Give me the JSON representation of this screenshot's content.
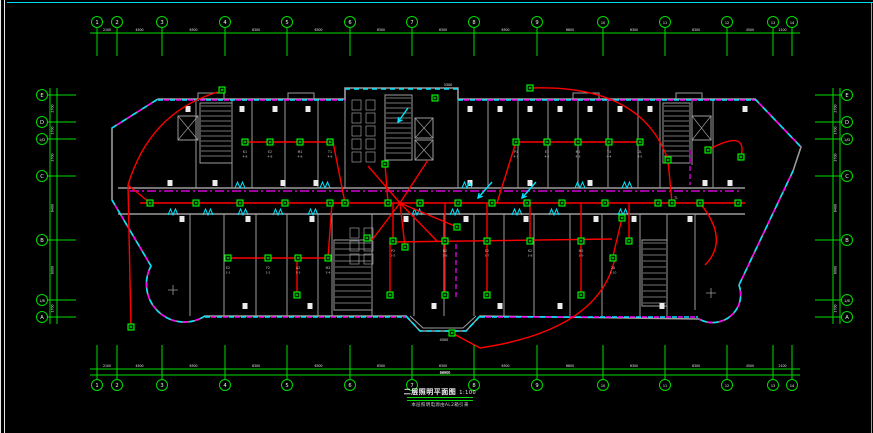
{
  "drawing": {
    "title": "二层照明平面图",
    "title_scale": "1:100",
    "subtitle": "本层照明电源由AL2箱引来",
    "colors": {
      "grid": "#00dc00",
      "bubble_text": "#e6ffe6",
      "dim_text": "#e8e8e8",
      "wall": "#9c9c9c",
      "wire": "#ff0000",
      "device": "#00ff00",
      "device_fill": "#002a00",
      "tray_cyan": "#00e5ff",
      "tray_magenta": "#ff00ff",
      "label": "#c8c8c8",
      "block": "#ececec"
    },
    "grid": {
      "top": {
        "labels": [
          "1",
          "2",
          "3",
          "4",
          "5",
          "6",
          "7",
          "8",
          "9",
          "10",
          "11",
          "12",
          "13",
          "14"
        ],
        "x": [
          97,
          117,
          162,
          225,
          287,
          350,
          412,
          474,
          537,
          603,
          665,
          727,
          773,
          792
        ],
        "bubble_y": 22,
        "line_y": 33,
        "stem_y1": 27,
        "stem_y2": 56,
        "dims": [
          "2100",
          "4500",
          "6300",
          "6300",
          "6300",
          "6300",
          "6300",
          "6300",
          "6600",
          "6300",
          "6300",
          "4500",
          "2100"
        ]
      },
      "bottom": {
        "labels": [
          "1",
          "2",
          "3",
          "4",
          "5",
          "6",
          "7",
          "8",
          "9",
          "10",
          "11",
          "12",
          "13",
          "14"
        ],
        "x": [
          97,
          117,
          162,
          225,
          287,
          350,
          412,
          474,
          537,
          603,
          665,
          727,
          773,
          792
        ],
        "bubble_y": 385,
        "line_y": 369,
        "line2_y": 375,
        "stem_y1": 345,
        "stem_y2": 379,
        "dims": [
          "2100",
          "4500",
          "6300",
          "6300",
          "6300",
          "6300",
          "6300",
          "6300",
          "6600",
          "6300",
          "6300",
          "4500",
          "2100"
        ],
        "overall": "66900"
      },
      "left": {
        "labels": [
          "E",
          "D",
          "1/D",
          "C",
          "B",
          "1/B",
          "A"
        ],
        "y": [
          95,
          122,
          139,
          176,
          240,
          300,
          317
        ],
        "bubble_x": 42,
        "line_x": [
          50,
          57
        ],
        "stem_x1": 47,
        "stem_x2": 76,
        "dims": [
          "2700",
          "1700",
          "3700",
          "6400",
          "6000",
          "1700"
        ]
      },
      "right": {
        "labels": [
          "E",
          "D",
          "1/D",
          "C",
          "B",
          "1/B",
          "A"
        ],
        "y": [
          95,
          122,
          139,
          176,
          240,
          300,
          317
        ],
        "bubble_x": 847,
        "line_x": [
          833,
          840
        ],
        "stem_x1": 815,
        "stem_x2": 842,
        "dims": [
          "2700",
          "1700",
          "3700",
          "6400",
          "6000",
          "1700"
        ]
      }
    },
    "stairs": [
      {
        "x": 200,
        "y": 103,
        "w": 32,
        "h": 60,
        "step": 5
      },
      {
        "x": 385,
        "y": 95,
        "w": 27,
        "h": 65,
        "step": 5
      },
      {
        "x": 663,
        "y": 103,
        "w": 27,
        "h": 60,
        "step": 5
      },
      {
        "x": 334,
        "y": 240,
        "w": 38,
        "h": 70,
        "step": 6
      },
      {
        "x": 642,
        "y": 240,
        "w": 25,
        "h": 66,
        "step": 6
      }
    ],
    "elevators": [
      {
        "x": 178,
        "y": 116,
        "w": 20,
        "h": 24
      },
      {
        "x": 415,
        "y": 118,
        "w": 18,
        "h": 20
      },
      {
        "x": 415,
        "y": 140,
        "w": 18,
        "h": 20
      },
      {
        "x": 692,
        "y": 116,
        "w": 19,
        "h": 24
      }
    ],
    "stalls": {
      "x": 352,
      "y": 100,
      "w": 9,
      "h": 10,
      "rows": 5,
      "cols": 2,
      "dx": 14,
      "dy": 13
    },
    "stalls2": {
      "x": 350,
      "y": 228,
      "w": 9,
      "h": 10,
      "rows": 3,
      "cols": 2,
      "dx": 14,
      "dy": 13
    },
    "white_blocks": [
      {
        "y": 109,
        "x": [
          188,
          242,
          275,
          308,
          470,
          500,
          530,
          560,
          590,
          620,
          650,
          745
        ]
      },
      {
        "y": 183,
        "x": [
          170,
          215,
          283,
          316,
          470,
          530,
          590,
          705,
          730
        ]
      },
      {
        "y": 219,
        "x": [
          182,
          248,
          312,
          406,
          466,
          526,
          596,
          634,
          690
        ]
      },
      {
        "y": 306,
        "x": [
          245,
          310,
          434,
          500,
          560,
          662
        ]
      }
    ],
    "dash_paths": [
      "M158,100 L345,100",
      "M458,100 L755,100",
      "M112,128 L158,99",
      "M755,99 L801,147",
      "M793,171 L739,285",
      "M112,200 L151,266",
      "M205,317 L406,317",
      "M480,317 L698,317",
      "M739,285 A28,28 0 0 1 699,319",
      "M205,316 A38,38 0 0 1 151,266"
    ],
    "cyan_paths": [
      "M345,89 L458,89",
      "M406,316 L420,331 L466,331 L480,316"
    ],
    "magenta_corridor": "M130,191 L740,191",
    "magenta_verts": [
      "M690,150 L690,185",
      "M456,244 L456,298"
    ],
    "doors": {
      "row1_y": 215,
      "row1_x": [
        168,
        203,
        238,
        273,
        308,
        412,
        450,
        512,
        549,
        618
      ],
      "row2_y": 188,
      "row2_x": [
        235,
        320,
        462,
        575,
        622
      ]
    },
    "arrows": [
      {
        "x1": 492,
        "y1": 182,
        "x2": 478,
        "y2": 198
      },
      {
        "x1": 536,
        "y1": 182,
        "x2": 522,
        "y2": 198
      },
      {
        "x1": 408,
        "y1": 108,
        "x2": 398,
        "y2": 122
      }
    ],
    "wires": [
      "M140,203 L745,203",
      "M128,185 Q150,112 218,92",
      "M128,185 L131,327",
      "M150,203 L128,185",
      "M243,142 L333,142",
      "M333,142 L345,203",
      "M388,203 L385,164",
      "M400,203 L368,166",
      "M400,203 L428,160",
      "M400,203 L372,240",
      "M400,203 L405,247",
      "M400,203 L438,242",
      "M400,203 L457,227",
      "M516,142 L497,203",
      "M516,142 L640,142",
      "M530,88 Q642,84 668,160",
      "M668,160 L672,203",
      "M708,150 Q748,128 741,157",
      "M228,258 L328,258",
      "M328,258 L332,203",
      "M297,258 L297,295",
      "M393,203 L393,241",
      "M445,203 L445,241",
      "M487,203 L487,241",
      "M530,203 L530,241",
      "M581,203 L581,241",
      "M629,203 L629,241",
      "M390,242 L612,239",
      "M390,242 L390,295",
      "M445,241 L445,295",
      "M487,241 L487,295",
      "M581,241 L581,295",
      "M622,218 L613,256",
      "M615,258 Q600,330 480,348",
      "M480,348 L452,333",
      "M700,203 Q730,240 705,265"
    ],
    "devices": [
      [
        245,
        142
      ],
      [
        270,
        142
      ],
      [
        300,
        142
      ],
      [
        330,
        142
      ],
      [
        516,
        142
      ],
      [
        547,
        142
      ],
      [
        578,
        142
      ],
      [
        609,
        142
      ],
      [
        640,
        142
      ],
      [
        708,
        150
      ],
      [
        741,
        157
      ],
      [
        150,
        203
      ],
      [
        196,
        203
      ],
      [
        240,
        203
      ],
      [
        285,
        203
      ],
      [
        330,
        203
      ],
      [
        345,
        203
      ],
      [
        388,
        203
      ],
      [
        420,
        203
      ],
      [
        458,
        203
      ],
      [
        492,
        203
      ],
      [
        527,
        203
      ],
      [
        562,
        203
      ],
      [
        605,
        203
      ],
      [
        658,
        203
      ],
      [
        672,
        203
      ],
      [
        700,
        203
      ],
      [
        738,
        203
      ],
      [
        228,
        258
      ],
      [
        268,
        258
      ],
      [
        298,
        258
      ],
      [
        328,
        258
      ],
      [
        393,
        241
      ],
      [
        445,
        241
      ],
      [
        487,
        241
      ],
      [
        530,
        241
      ],
      [
        581,
        241
      ],
      [
        629,
        241
      ],
      [
        297,
        295
      ],
      [
        390,
        295
      ],
      [
        445,
        295
      ],
      [
        487,
        295
      ],
      [
        581,
        295
      ],
      [
        613,
        258
      ],
      [
        222,
        90
      ],
      [
        435,
        98
      ],
      [
        530,
        88
      ],
      [
        668,
        160
      ],
      [
        385,
        164
      ],
      [
        457,
        227
      ],
      [
        622,
        218
      ],
      [
        131,
        327
      ],
      [
        452,
        333
      ],
      [
        367,
        238
      ],
      [
        405,
        247
      ]
    ],
    "room_labels": [
      {
        "x": 245,
        "y": 150,
        "t": "K1",
        "t2": "4-8"
      },
      {
        "x": 270,
        "y": 150,
        "t": "E2",
        "t2": "4-8"
      },
      {
        "x": 300,
        "y": 150,
        "t": "M1",
        "t2": "4-8"
      },
      {
        "x": 330,
        "y": 150,
        "t": "T1",
        "t2": "4-8"
      },
      {
        "x": 516,
        "y": 150,
        "t": "P1",
        "t2": "4-1"
      },
      {
        "x": 547,
        "y": 150,
        "t": "E1",
        "t2": "4-2"
      },
      {
        "x": 578,
        "y": 150,
        "t": "M1",
        "t2": "4-3"
      },
      {
        "x": 609,
        "y": 150,
        "t": "T4",
        "t2": "4-4"
      },
      {
        "x": 640,
        "y": 150,
        "t": "2L",
        "t2": "4-5"
      },
      {
        "x": 228,
        "y": 266,
        "t": "E2",
        "t2": "3-1"
      },
      {
        "x": 268,
        "y": 266,
        "t": "F2",
        "t2": "3-2"
      },
      {
        "x": 298,
        "y": 266,
        "t": "A2",
        "t2": "3-3"
      },
      {
        "x": 328,
        "y": 266,
        "t": "M2",
        "t2": "3-4"
      },
      {
        "x": 393,
        "y": 249,
        "t": "P2",
        "t2": "3-5"
      },
      {
        "x": 445,
        "y": 249,
        "t": "B2",
        "t2": "3-6"
      },
      {
        "x": 487,
        "y": 249,
        "t": "E2",
        "t2": "3-7"
      },
      {
        "x": 530,
        "y": 249,
        "t": "K2",
        "t2": "3-8"
      },
      {
        "x": 581,
        "y": 249,
        "t": "M2",
        "t2": "3-9"
      },
      {
        "x": 613,
        "y": 266,
        "t": "2A",
        "t2": "3-10"
      },
      {
        "x": 676,
        "y": 196,
        "t": "TL",
        "t2": ""
      }
    ],
    "dims_misc": [
      {
        "x": 448,
        "y": 86,
        "t": "3300"
      },
      {
        "x": 444,
        "y": 341,
        "t": "4500"
      },
      {
        "x": 445,
        "y": 374,
        "t": "66900"
      }
    ]
  }
}
